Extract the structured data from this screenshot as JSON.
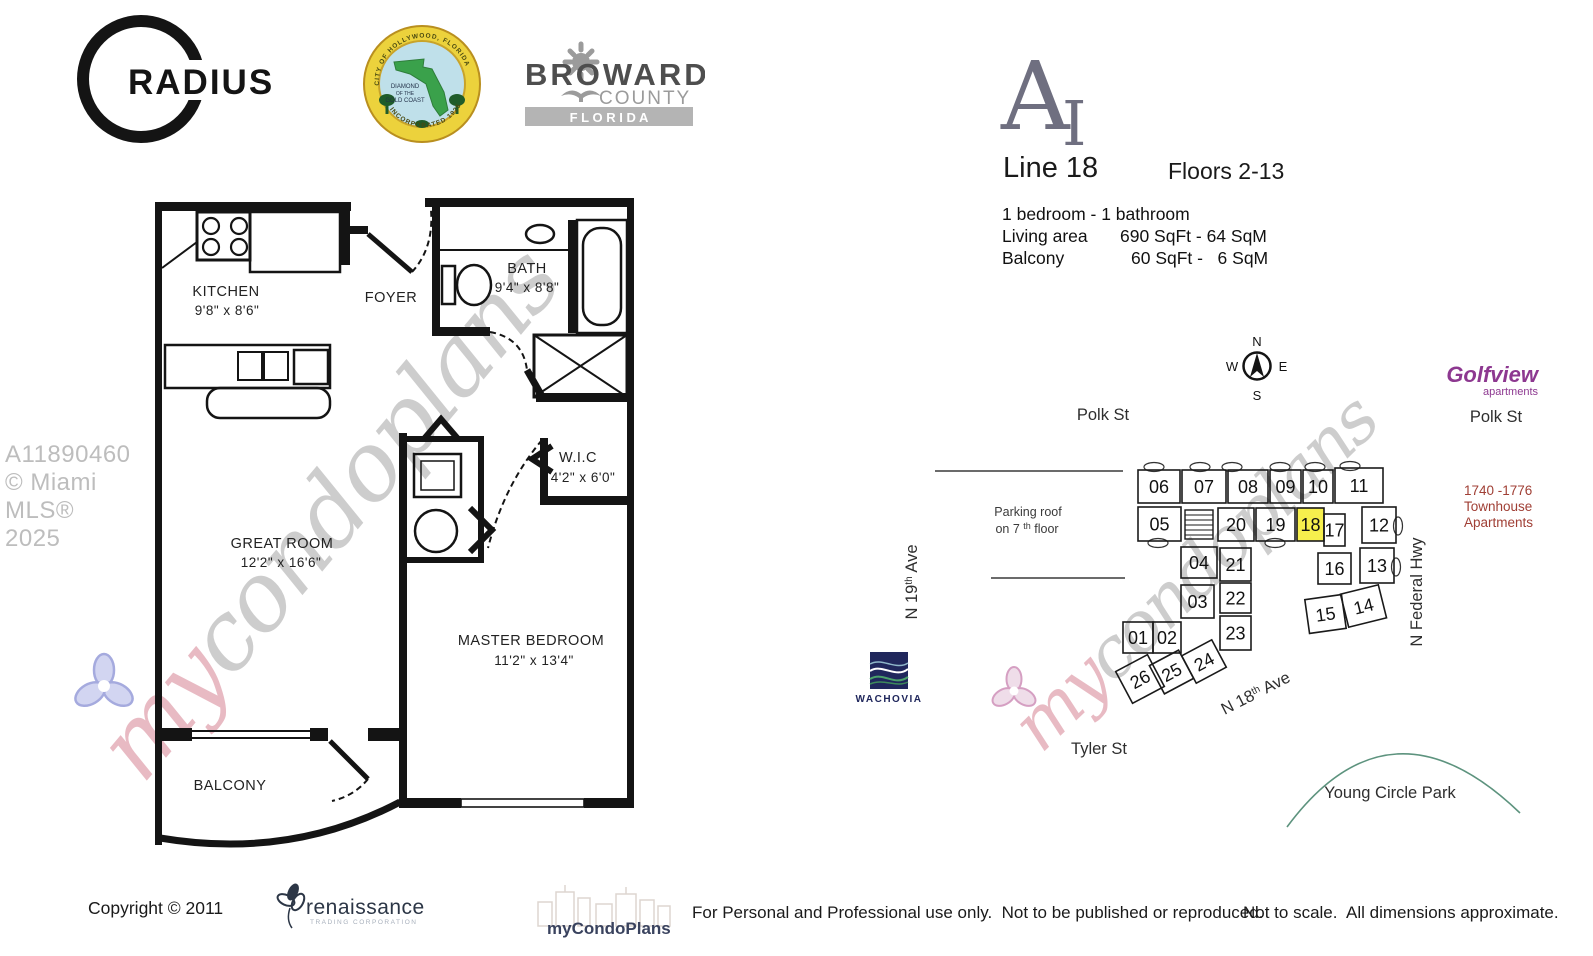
{
  "header": {
    "radius": "RADIUS",
    "seal": {
      "arc_top": "CITY OF HOLLYWOOD, FLORIDA",
      "center1": "DIAMOND",
      "center2": "OF THE",
      "center3": "GOLD COAST",
      "arc_bottom": "INCORPORATED 1925"
    },
    "broward": {
      "name": "BROWARD",
      "county": "COUNTY",
      "state": "F L O R I D A"
    },
    "model": {
      "letter": "A",
      "numeral": "I"
    },
    "line": "Line 18",
    "floors": "Floors 2-13",
    "bedbath": "1 bedroom - 1 bathroom",
    "living_label": "Living area",
    "living_value": "690 SqFt - 64 SqM",
    "balcony_label": "Balcony",
    "balcony_value": "60 SqFt -   6 SqM"
  },
  "floorplan": {
    "kitchen": {
      "name": "KITCHEN",
      "dims": "9'8\" x 8'6\""
    },
    "foyer": {
      "name": "FOYER"
    },
    "bath": {
      "name": "BATH",
      "dims": "9'4\" x 8'8\""
    },
    "wic": {
      "name": "W.I.C",
      "dims": "4'2\" x 6'0\""
    },
    "great": {
      "name": "GREAT ROOM",
      "dims": "12'2\" x 16'6\""
    },
    "master": {
      "name": "MASTER BEDROOM",
      "dims": "11'2\" x 13'4\""
    },
    "balcony": {
      "name": "BALCONY"
    }
  },
  "sitemap": {
    "compass": {
      "n": "N",
      "s": "S",
      "e": "E",
      "w": "W"
    },
    "streets": {
      "polk_left": "Polk St",
      "polk_right": "Polk St",
      "tyler": "Tyler St",
      "n19_pre": "N 19",
      "n19_sup": "th",
      "n19_post": " Ave",
      "n18_pre": "N 18",
      "n18_sup": "th",
      "n18_post": " Ave",
      "federal": "N Federal Hwy"
    },
    "parking_line1": "Parking roof",
    "parking_line2_pre": "on 7 ",
    "parking_line2_sup": "th",
    "parking_line2_post": " floor",
    "golfview": {
      "name": "Golfview",
      "sub": "apartments"
    },
    "townhouse": {
      "line1": "1740 -1776",
      "line2": "Townhouse",
      "line3": "Apartments"
    },
    "park": "Young Circle Park",
    "wachovia": "WACHOVIA",
    "highlight_color": "#f6ef4d",
    "highlighted_unit": "18",
    "units": [
      {
        "n": "06",
        "x": 288,
        "y": 140,
        "w": 42,
        "h": 33,
        "r": 0
      },
      {
        "n": "07",
        "x": 332,
        "y": 140,
        "w": 44,
        "h": 33,
        "r": 0
      },
      {
        "n": "08",
        "x": 378,
        "y": 140,
        "w": 40,
        "h": 33,
        "r": 0
      },
      {
        "n": "09",
        "x": 420,
        "y": 140,
        "w": 31,
        "h": 33,
        "r": 0
      },
      {
        "n": "10",
        "x": 453,
        "y": 140,
        "w": 30,
        "h": 33,
        "r": 0
      },
      {
        "n": "11",
        "x": 485,
        "y": 138,
        "w": 48,
        "h": 35,
        "r": 0
      },
      {
        "n": "05",
        "x": 288,
        "y": 177,
        "w": 43,
        "h": 34,
        "r": 0
      },
      {
        "n": "20",
        "x": 368,
        "y": 178,
        "w": 36,
        "h": 33,
        "r": 0
      },
      {
        "n": "19",
        "x": 406,
        "y": 178,
        "w": 39,
        "h": 33,
        "r": 0
      },
      {
        "n": "18",
        "x": 447,
        "y": 178,
        "w": 27,
        "h": 33,
        "r": 0,
        "hl": true
      },
      {
        "n": "17",
        "x": 474,
        "y": 184,
        "w": 21,
        "h": 32,
        "r": 0
      },
      {
        "n": "12",
        "x": 512,
        "y": 177,
        "w": 34,
        "h": 36,
        "r": 0
      },
      {
        "n": "04",
        "x": 331,
        "y": 217,
        "w": 36,
        "h": 31,
        "r": 0
      },
      {
        "n": "21",
        "x": 370,
        "y": 218,
        "w": 31,
        "h": 33,
        "r": 0
      },
      {
        "n": "16",
        "x": 468,
        "y": 223,
        "w": 33,
        "h": 31,
        "r": 0
      },
      {
        "n": "13",
        "x": 510,
        "y": 218,
        "w": 34,
        "h": 35,
        "r": 0
      },
      {
        "n": "03",
        "x": 331,
        "y": 255,
        "w": 33,
        "h": 33,
        "r": 0
      },
      {
        "n": "22",
        "x": 370,
        "y": 253,
        "w": 31,
        "h": 30,
        "r": 0
      },
      {
        "n": "23",
        "x": 370,
        "y": 286,
        "w": 31,
        "h": 34,
        "r": 0
      },
      {
        "n": "15",
        "x": 457,
        "y": 267,
        "w": 37,
        "h": 34,
        "r": -8
      },
      {
        "n": "14",
        "x": 494,
        "y": 259,
        "w": 39,
        "h": 34,
        "r": -14
      },
      {
        "n": "01",
        "x": 273,
        "y": 292,
        "w": 30,
        "h": 31,
        "r": 0
      },
      {
        "n": "02",
        "x": 303,
        "y": 292,
        "w": 28,
        "h": 31,
        "r": 0
      },
      {
        "n": "24",
        "x": 337,
        "y": 316,
        "w": 34,
        "h": 31,
        "r": -28
      },
      {
        "n": "25",
        "x": 305,
        "y": 326,
        "w": 33,
        "h": 32,
        "r": -28
      },
      {
        "n": "26",
        "x": 272,
        "y": 331,
        "w": 36,
        "h": 36,
        "r": -28
      }
    ]
  },
  "watermarks": {
    "mls": "A11890460 © Miami MLS® 2025",
    "script_my": "my",
    "script_rest": "condoplans"
  },
  "footer": {
    "copyright": "Copyright © 2011",
    "ren_name": "renaissance",
    "ren_sub": "TRADING CORPORATION",
    "mcp": "myCondoPlans",
    "usage": "For Personal and Professional use only.  Not to be published or reproduced.",
    "scale": "Not to scale.  All dimensions approximate."
  }
}
